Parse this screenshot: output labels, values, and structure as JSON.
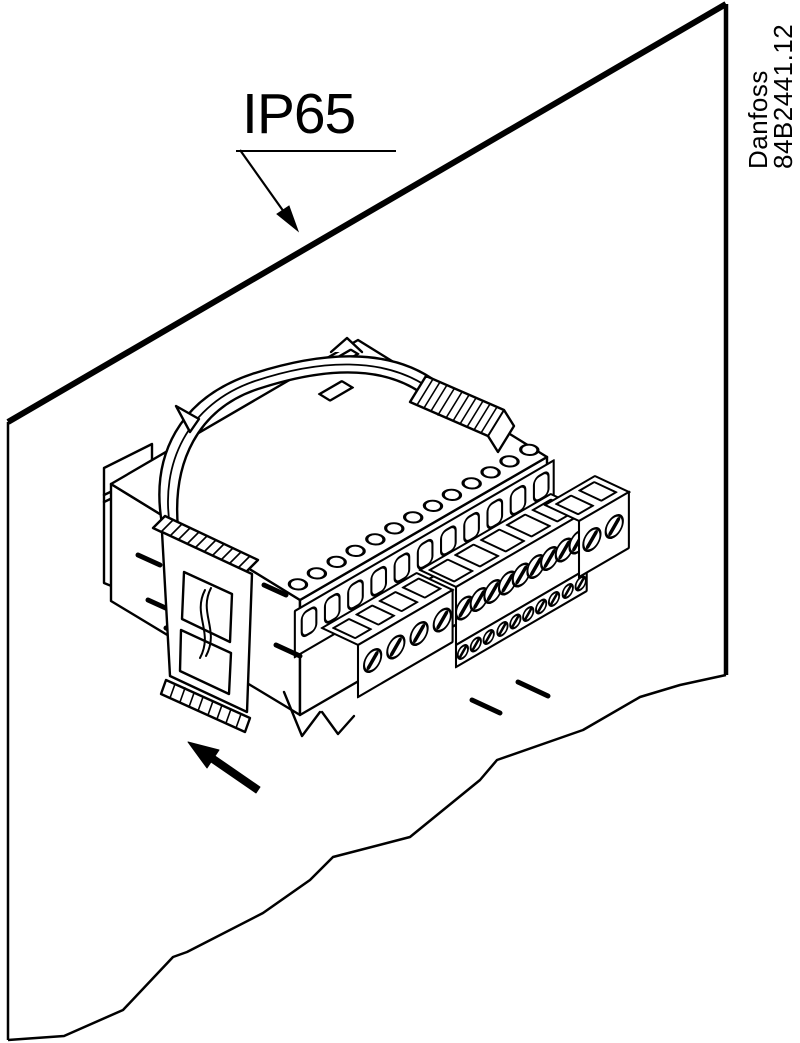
{
  "figure": {
    "background_color": "#ffffff",
    "line_color": "#000000",
    "protection_rating": "IP65",
    "side_label": {
      "brand": "Danfoss",
      "drawing_number": "84B2441.12"
    },
    "icons": {
      "ip65_leader_arrow": "↘",
      "insertion_arrow": "↖"
    }
  }
}
